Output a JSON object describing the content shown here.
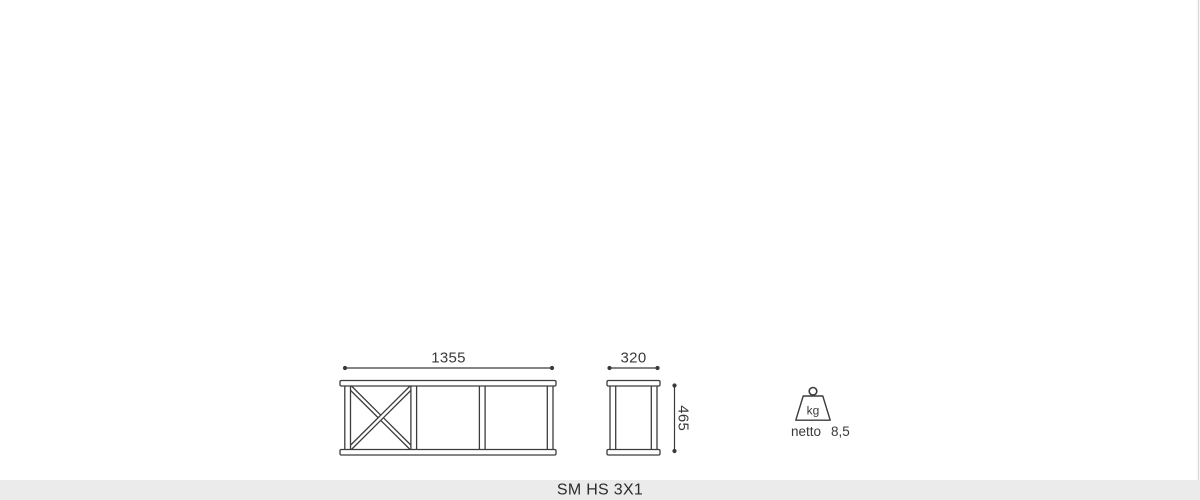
{
  "dimensions": {
    "front_width_mm": "1355",
    "side_depth_mm": "320",
    "side_height_mm": "465"
  },
  "weight": {
    "icon": "weight-kg-icon",
    "unit": "kg",
    "label": "netto",
    "value": "8,5"
  },
  "footer": {
    "product_name": "SM HS 3X1"
  },
  "colors": {
    "line": "#3c3c3c",
    "dimension_text": "#3a3a3a",
    "footer_bg": "#ebebeb",
    "footer_text": "#2b2b2b",
    "right_edge_line": "#d9d9d9"
  }
}
